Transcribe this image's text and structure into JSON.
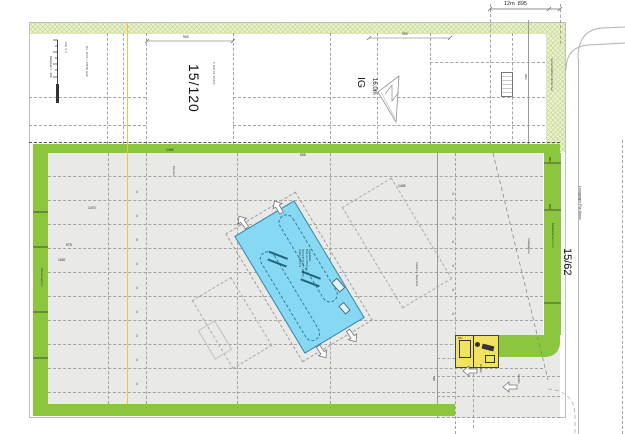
{
  "plan": {
    "parcel_upper_label": "15/120",
    "zone_code": "IG",
    "zone_height": "16,0m",
    "parcel_right_label": "15/62",
    "street_name": "Leonganger-Flur-Gasse",
    "top_dimension": "12m  895",
    "scale_caption": "Maßstab 1 : 200",
    "scale_ticks": "10m  5  0",
    "building_note": "Lagerhalle\nBGF ca. 2.870 m²\nOK FFB ±0,00 = 428,50\nAttika +16,00 m",
    "stall_counts_left": "4\n4\n5\n4\n4\n4\n3\n4\n4",
    "stall_counts_right": "4\n4\n4\n4\n4\n4",
    "dimensions": [
      {
        "text": "900"
      },
      {
        "text": "900"
      },
      {
        "text": "1405"
      },
      {
        "text": "1405"
      },
      {
        "text": "1470"
      },
      {
        "text": "975"
      },
      {
        "text": "1160"
      },
      {
        "text": "885"
      },
      {
        "text": "500"
      },
      {
        "text": "605"
      },
      {
        "text": "20m"
      },
      {
        "text": "595"
      }
    ],
    "notes": [
      {
        "text": "Niv. ±0,00 = 428,50 müA"
      },
      {
        "text": "lt. GST-Nr. 15/120"
      },
      {
        "text": "Verkehrsfläche öffentl. Gut"
      },
      {
        "text": "Baufluchtlinie 3,0 m"
      },
      {
        "text": "Zufahrt lt. Bescheid"
      },
      {
        "text": "Einfahrt"
      },
      {
        "text": "Ausfahrt"
      },
      {
        "text": "Bestandsgrenze"
      },
      {
        "text": "Schleppkurve"
      },
      {
        "text": "Bestand"
      },
      {
        "text": "WC"
      }
    ],
    "colors": {
      "band_green": "#8cc63e",
      "hatch_fill": "#eaf2cd",
      "hatch_line": "#c6d897",
      "area_gray": "#e9e9e8",
      "building_blue": "#87d9f3",
      "building_edge": "#3d85a6",
      "highlight_yellow": "#f1e262",
      "guide_orange": "#f0c24b"
    }
  }
}
